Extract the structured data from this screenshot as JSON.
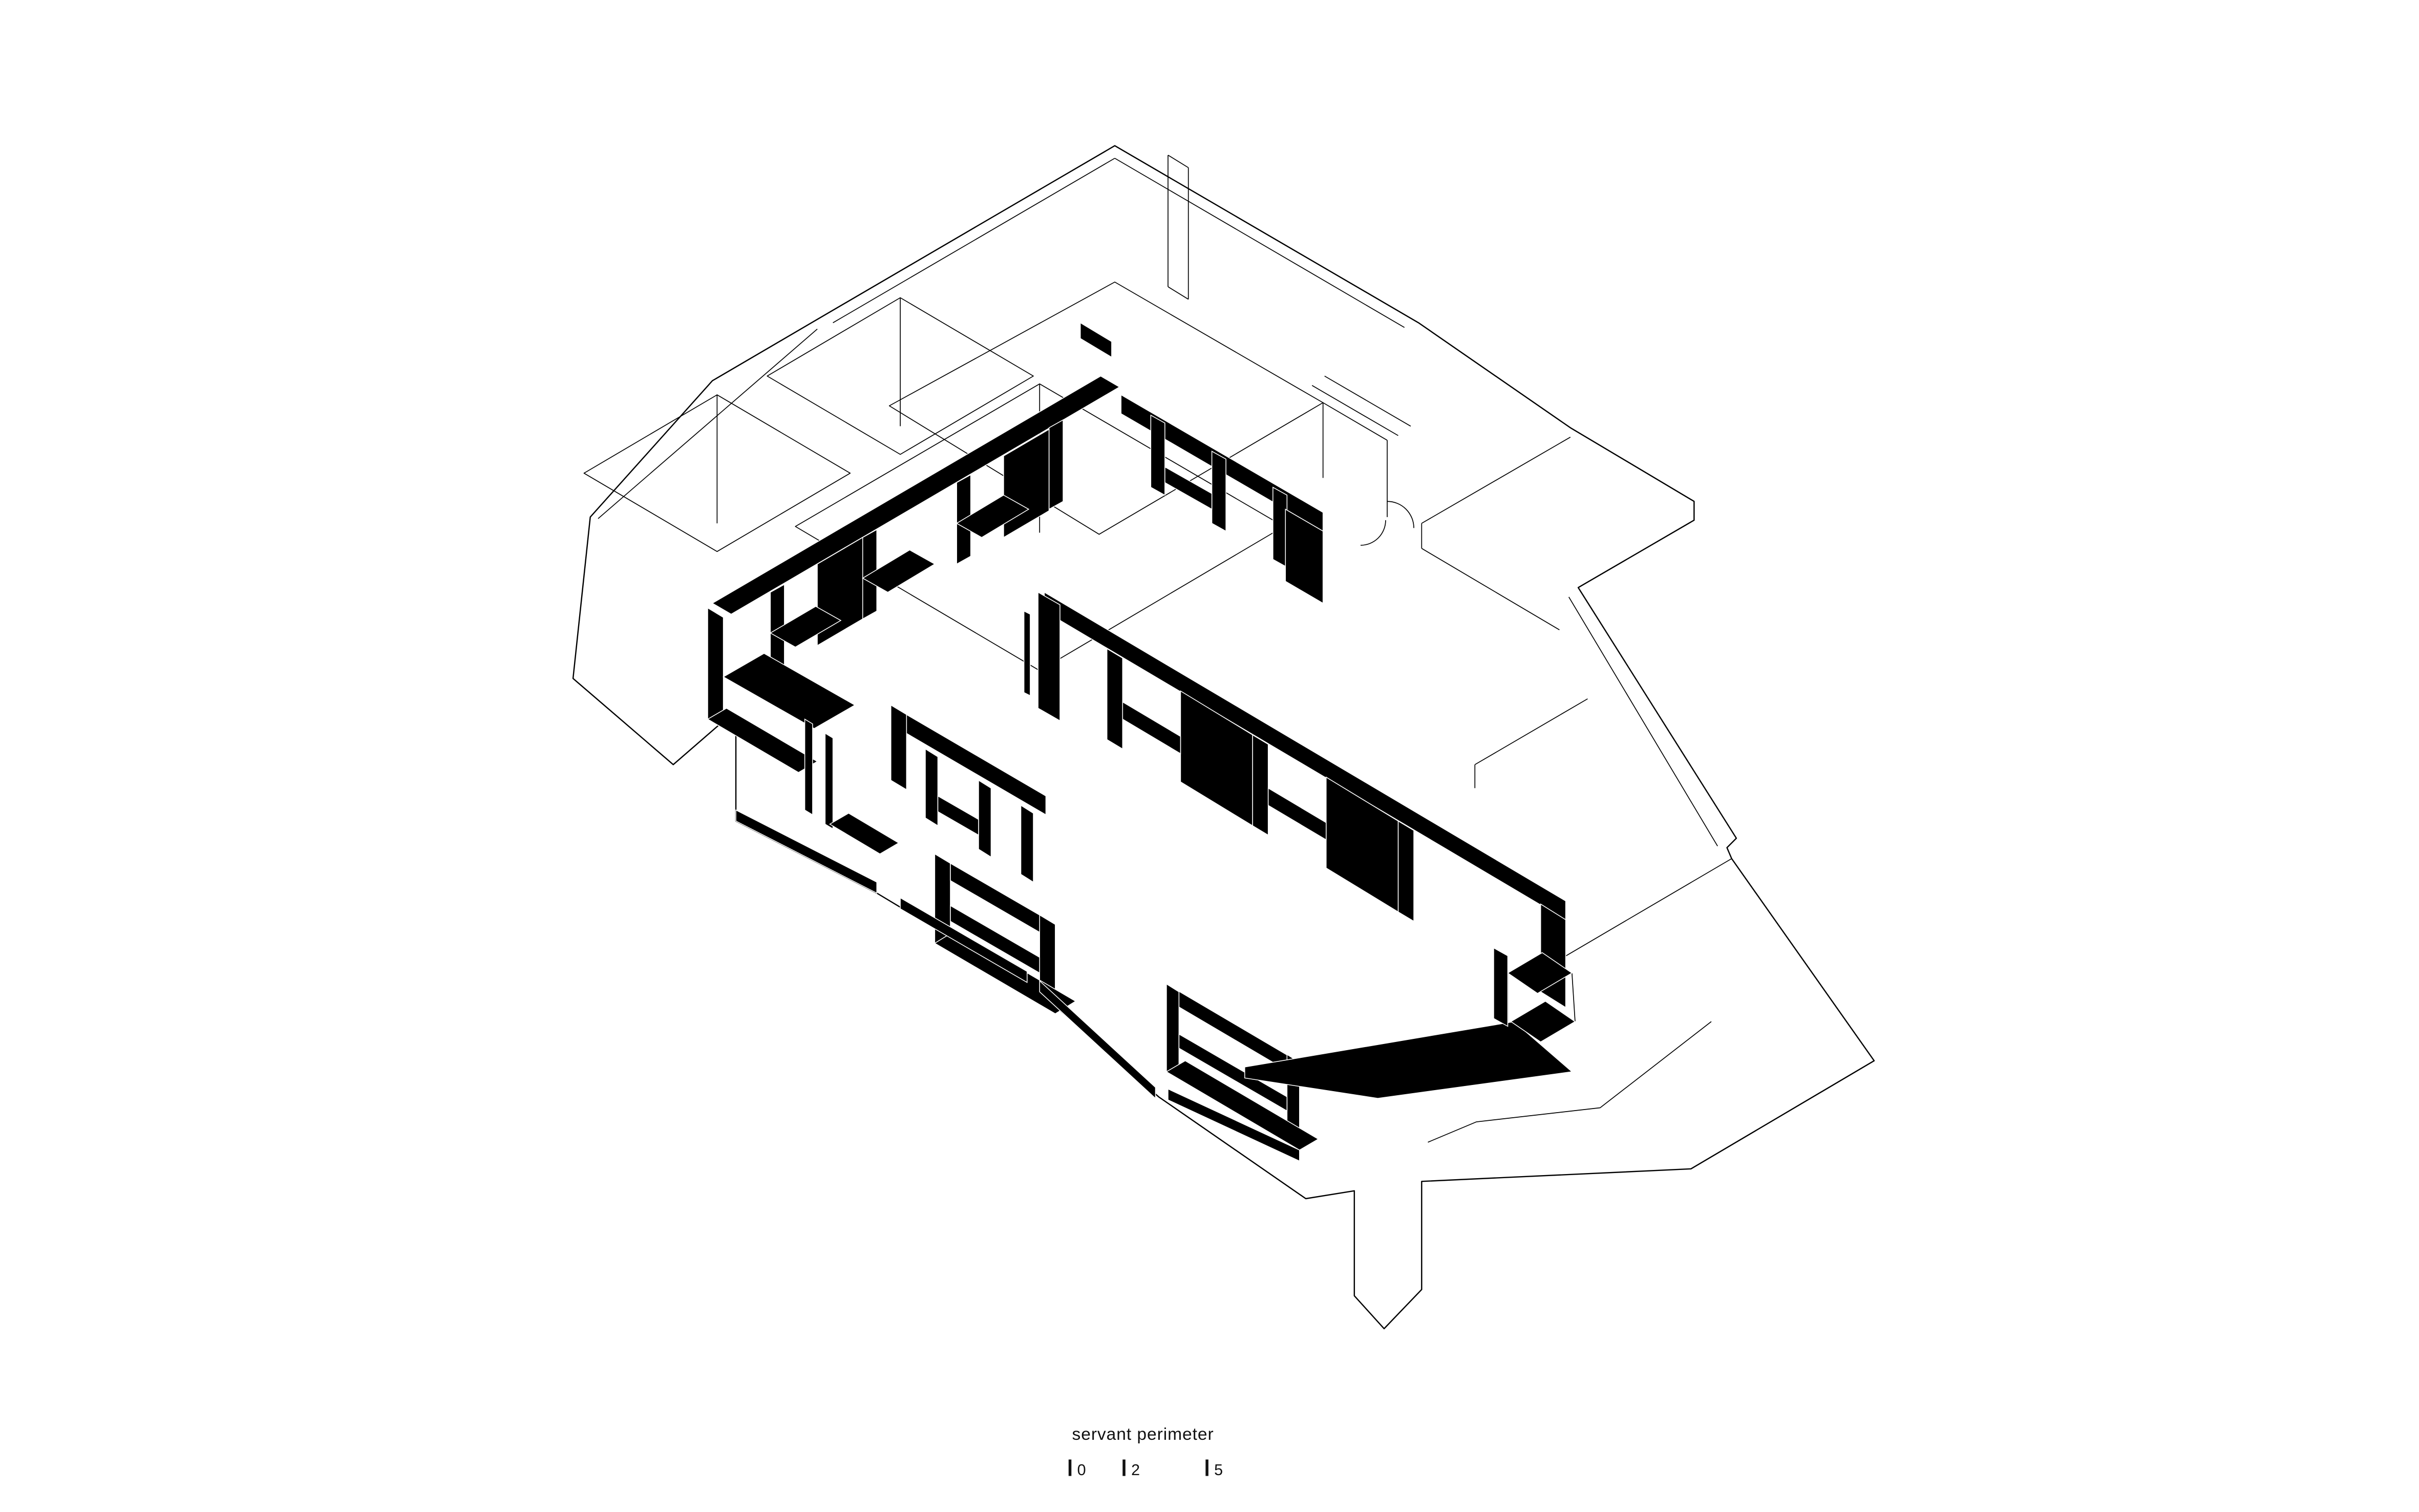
{
  "figure": {
    "name": "axonometric-floor-plan",
    "caption": "servant perimeter",
    "drawing_style": "black and white architectural axonometric",
    "elements": {
      "millwork": "servant perimeter cabinetry bands rendered solid black",
      "walls": "thin black outline walls and floor slab",
      "floor_edge": "black plinth strips and corner wedge along lower floor edge"
    }
  },
  "scale_bar": {
    "markers": [
      "0",
      "2",
      "5"
    ]
  },
  "colors": {
    "background": "#ffffff",
    "ink": "#000000",
    "fill": "#000000"
  }
}
